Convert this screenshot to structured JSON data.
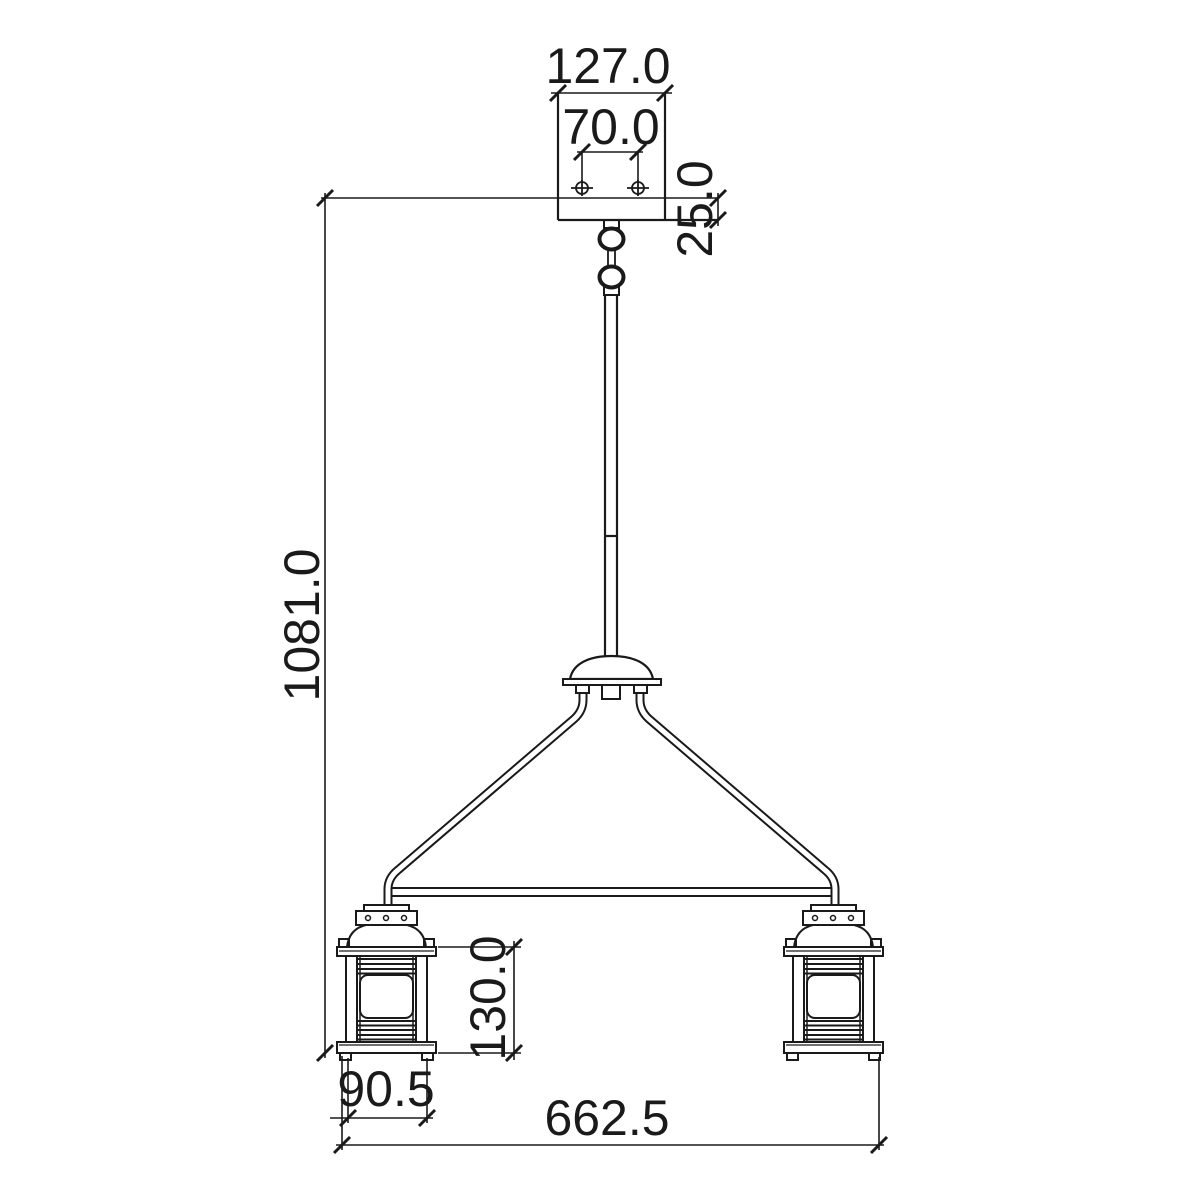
{
  "canvas": {
    "background": "#ffffff",
    "ink": "#1a1a1a"
  },
  "drawing": {
    "type": "technical-dimension-drawing",
    "dims": {
      "canopy_width": "127.0",
      "screw_spacing": "70.0",
      "canopy_height": "25.0",
      "overall_height": "1081.0",
      "lantern_height": "130.0",
      "lantern_width": "90.5",
      "overall_width": "662.5"
    }
  }
}
